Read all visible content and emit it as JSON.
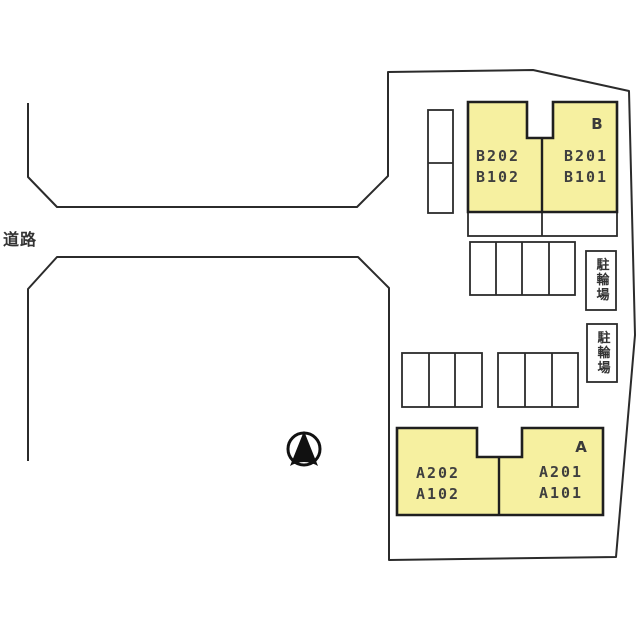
{
  "labels": {
    "road": "道路",
    "bike_parking": "駐輪場"
  },
  "buildings": [
    {
      "name": "B",
      "left_units": [
        "B202",
        "B102"
      ],
      "right_units": [
        "B201",
        "B101"
      ]
    },
    {
      "name": "A",
      "left_units": [
        "A202",
        "A102"
      ],
      "right_units": [
        "A201",
        "A101"
      ]
    }
  ],
  "icons": {
    "north_arrow": "north-arrow"
  },
  "colors": {
    "background": "#ffffff",
    "building_fill": "#F6F0A0",
    "outline": "#2b2b2b",
    "building_stroke": "#1f1f1f",
    "text": "#3f3f3f"
  }
}
